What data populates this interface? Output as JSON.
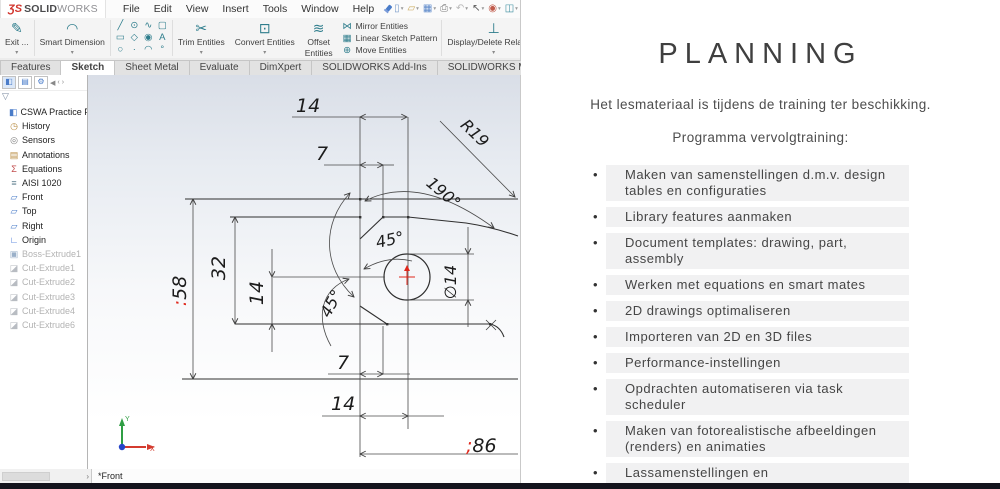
{
  "brand": {
    "logo_mark": "ƷS",
    "logo_bold": "SOLID",
    "logo_light": "WORKS"
  },
  "menubar": {
    "menus": [
      "File",
      "Edit",
      "View",
      "Insert",
      "Tools",
      "Window",
      "Help"
    ],
    "quick_icons": [
      {
        "name": "new-document-icon",
        "glyph": "▯",
        "color": "#7a9bc9"
      },
      {
        "name": "open-document-icon",
        "glyph": "▱",
        "color": "#c9a85a"
      },
      {
        "name": "save-icon",
        "glyph": "▦",
        "color": "#5a87c9"
      },
      {
        "name": "print-icon",
        "glyph": "⎙",
        "color": "#7a7a7a"
      },
      {
        "name": "undo-icon",
        "glyph": "↶",
        "color": "#b8b8b8"
      },
      {
        "name": "select-cursor-icon",
        "glyph": "↖",
        "color": "#555555"
      },
      {
        "name": "options-glasses-icon",
        "glyph": "◉",
        "color": "#c05a4a"
      },
      {
        "name": "design-library-icon",
        "glyph": "◫",
        "color": "#3f8fa0"
      },
      {
        "name": "settings-gear-icon",
        "glyph": "⚙",
        "color": "#777777"
      }
    ]
  },
  "cmd": {
    "exit_label": "Exit ...",
    "exit_icon": "✎",
    "smart_dimension": "Smart Dimension",
    "smart_dimension_icon": "◠",
    "sketch_entities": [
      {
        "name": "line-icon",
        "glyph": "╱"
      },
      {
        "name": "circle-icon",
        "glyph": "⊙"
      },
      {
        "name": "spline-icon",
        "glyph": "∿"
      },
      {
        "name": "slot-icon",
        "glyph": "▢"
      },
      {
        "name": "rectangle-icon",
        "glyph": "▭"
      },
      {
        "name": "polygon-icon",
        "glyph": "◇"
      },
      {
        "name": "perimeter-circle-icon",
        "glyph": "◉"
      },
      {
        "name": "text-icon",
        "glyph": "A"
      },
      {
        "name": "ellipse-icon",
        "glyph": "○"
      },
      {
        "name": "point-icon",
        "glyph": "·"
      },
      {
        "name": "arc-icon",
        "glyph": "◠"
      },
      {
        "name": "fillet-icon",
        "glyph": "°"
      }
    ],
    "trim": "Trim Entities",
    "trim_icon": "✂",
    "convert": "Convert Entities",
    "convert_icon": "⊡",
    "offset_line1": "Offset",
    "offset_line2": "Entities",
    "offset_icon": "≋",
    "stack": [
      {
        "icon_name": "mirror-entities-icon",
        "glyph": "⋈",
        "label": "Mirror Entities"
      },
      {
        "icon_name": "linear-pattern-icon",
        "glyph": "▦",
        "label": "Linear Sketch Pattern"
      },
      {
        "icon_name": "move-entities-icon",
        "glyph": "⊕",
        "label": "Move Entities"
      }
    ],
    "display_delete": "Display/Delete Relations",
    "display_delete_icon": "⊥",
    "repair_line1": "Repair",
    "repair_line2": "Sketch",
    "repair_icon": "⟲",
    "quick": "Qui...",
    "quick_icon": "⌖",
    "rapid_line1": "Ra...",
    "rapid_line2": "Sk...",
    "rapid_icon": "▨"
  },
  "tabs": [
    {
      "label": "Features",
      "active": false
    },
    {
      "label": "Sketch",
      "active": true
    },
    {
      "label": "Sheet Metal",
      "active": false
    },
    {
      "label": "Evaluate",
      "active": false
    },
    {
      "label": "DimXpert",
      "active": false
    },
    {
      "label": "SOLIDWORKS Add-Ins",
      "active": false
    },
    {
      "label": "SOLIDWORKS MBD",
      "active": false
    }
  ],
  "headsup_icons": [
    {
      "name": "zoom-fit-icon",
      "glyph": "⌕"
    },
    {
      "name": "zoom-area-icon",
      "glyph": "⌗"
    },
    {
      "name": "previous-view-icon",
      "glyph": "↺"
    },
    {
      "name": "section-view-icon",
      "glyph": "◧"
    },
    {
      "name": "view-orientation-icon",
      "glyph": "◇"
    },
    {
      "name": "display-style-icon",
      "glyph": "◫"
    },
    {
      "name": "hide-show-icon",
      "glyph": "◔"
    }
  ],
  "tree": {
    "filter_icon": "▽",
    "items": [
      {
        "label": "CSWA Practice Part",
        "icon": "part",
        "grayed": false,
        "root": true
      },
      {
        "label": "History",
        "icon": "history",
        "grayed": false
      },
      {
        "label": "Sensors",
        "icon": "sensors",
        "grayed": false
      },
      {
        "label": "Annotations",
        "icon": "annotations",
        "grayed": false
      },
      {
        "label": "Equations",
        "icon": "equations",
        "grayed": false
      },
      {
        "label": "AISI 1020",
        "icon": "material",
        "grayed": false
      },
      {
        "label": "Front",
        "icon": "plane",
        "grayed": false
      },
      {
        "label": "Top",
        "icon": "plane",
        "grayed": false
      },
      {
        "label": "Right",
        "icon": "plane",
        "grayed": false
      },
      {
        "label": "Origin",
        "icon": "origin",
        "grayed": false
      },
      {
        "label": "Boss-Extrude1",
        "icon": "boss",
        "grayed": true
      },
      {
        "label": "Cut-Extrude1",
        "icon": "cut",
        "grayed": true
      },
      {
        "label": "Cut-Extrude2",
        "icon": "cut",
        "grayed": true
      },
      {
        "label": "Cut-Extrude3",
        "icon": "cut",
        "grayed": true
      },
      {
        "label": "Cut-Extrude4",
        "icon": "cut",
        "grayed": true
      },
      {
        "label": "Cut-Extrude6",
        "icon": "cut",
        "grayed": true
      }
    ]
  },
  "sketch": {
    "dim_top_width": "14",
    "dim_top_offset": "7",
    "dim_radius": "R19",
    "dim_angle_190": "190°",
    "dim_angle_45_upper": "45°",
    "dim_angle_45_lower": "45°",
    "dim_height_32": "32",
    "dim_left_14": "14",
    "dim_58_prefix": ":",
    "dim_58": "58",
    "dim_hole": "∅14",
    "dim_bottom_7": "7",
    "dim_bottom_14": "14",
    "dim_86_prefix": ";",
    "dim_86": "86",
    "axis_x": "X",
    "axis_y": "Y"
  },
  "viewport": {
    "orientation": "*Front"
  },
  "planning": {
    "title": "PLANNING",
    "intro": "Het lesmateriaal is tijdens de training ter beschikking.",
    "subtitle": "Programma vervolgtraining:",
    "bullets": [
      "Maken van samenstellingen d.m.v. design tables en configuraties",
      "Library features aanmaken",
      "Document templates: drawing, part, assembly",
      "Werken met equations en smart mates",
      "2D drawings optimaliseren",
      "Importeren van 2D en 3D files",
      "Performance-instellingen",
      "Opdrachten automatiseren via task scheduler",
      "Maken van fotorealistische afbeeldingen (renders) en animaties",
      "Lassamenstellingen en plooiwerkonderdelen"
    ]
  },
  "colors": {
    "accent_red": "#e0271b",
    "icon_teal": "#2e7d8c",
    "statusbar": "#14141d"
  }
}
